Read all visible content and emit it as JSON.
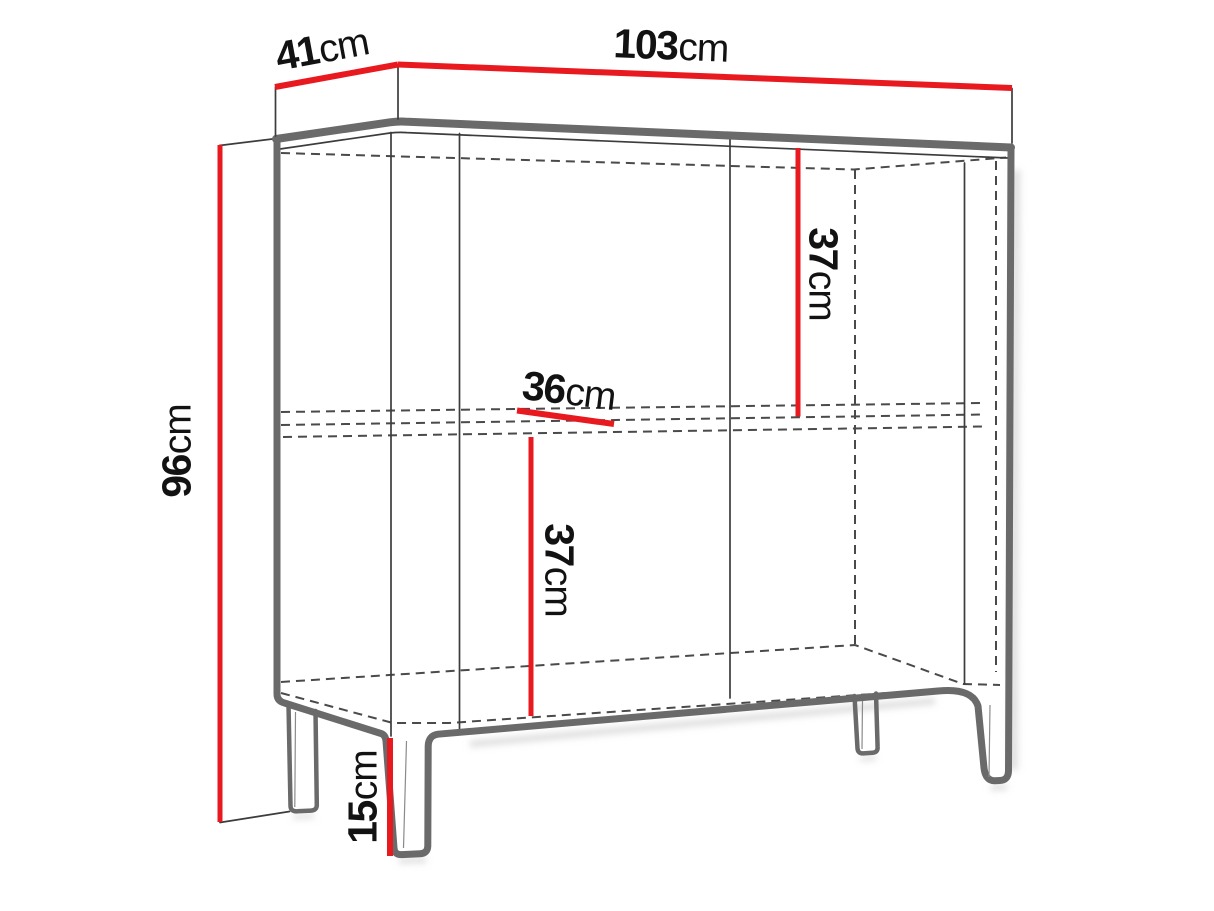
{
  "diagram": {
    "title": "cabinet-dimension-drawing",
    "labels": {
      "depth": {
        "value": "41",
        "unit": "cm"
      },
      "width": {
        "value": "103",
        "unit": "cm"
      },
      "height": {
        "value": "96",
        "unit": "cm"
      },
      "upper_compartment_height": {
        "value": "37",
        "unit": "cm"
      },
      "shelf_depth": {
        "value": "36",
        "unit": "cm"
      },
      "lower_compartment_height": {
        "value": "37",
        "unit": "cm"
      },
      "leg_height": {
        "value": "15",
        "unit": "cm"
      }
    },
    "colors": {
      "dimension_line": "#e8191f",
      "outline": "#6a6a6a",
      "thin_line": "#3c3c3c",
      "text": "#121212",
      "background": "#ffffff"
    }
  }
}
